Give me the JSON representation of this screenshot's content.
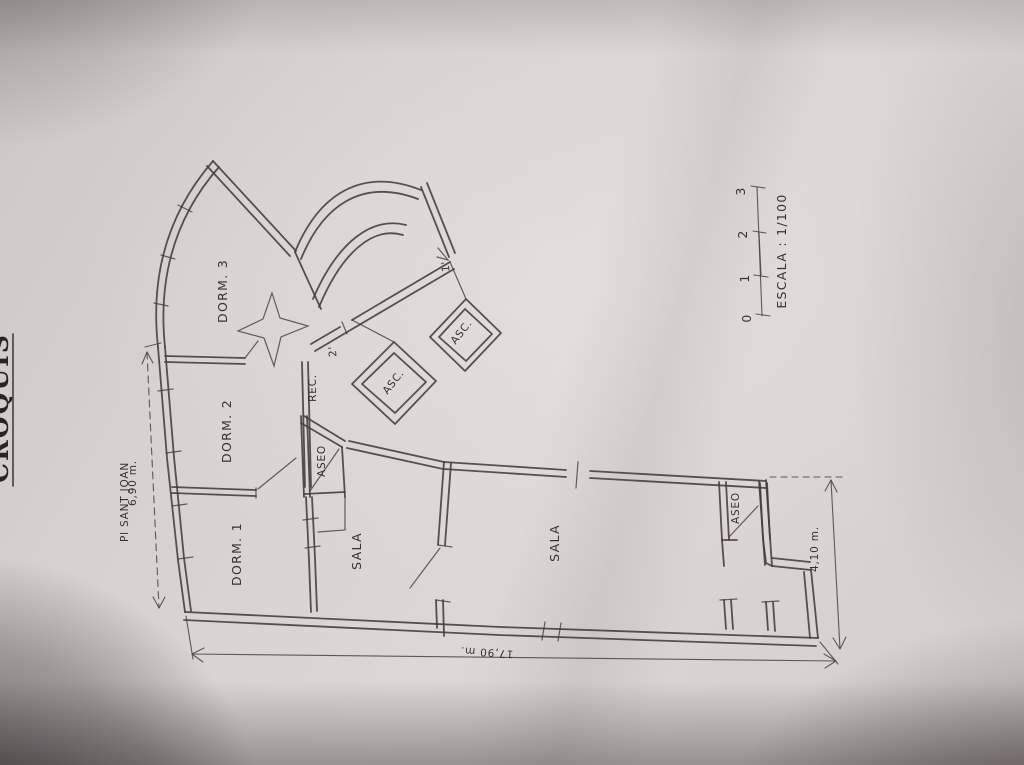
{
  "photo": {
    "title_fragment": "CROQUIS",
    "street_label": "Pl SANT JOAN",
    "paper_color": "#d8d1d1",
    "ink_color": "#3f3836"
  },
  "plan": {
    "rooms": {
      "dorm3": "DORM. 3",
      "dorm2": "DORM. 2",
      "dorm1": "DORM. 1",
      "sala_left": "SALA",
      "sala_right": "SALA",
      "rec": "REC.",
      "aseo_left": "ASEO",
      "aseo_right": "ASEO",
      "asc_lower": "ASC.",
      "asc_upper": "ASC."
    },
    "marks": {
      "entry_1": "1'",
      "entry_2": "2'"
    },
    "dimensions": {
      "left": "6,90 m.",
      "bottom": "17,90 m.",
      "right": "4,10 m."
    }
  },
  "scale_bar": {
    "ticks": [
      "0",
      "1",
      "2",
      "3"
    ],
    "label": "ESCALA : 1/100"
  }
}
